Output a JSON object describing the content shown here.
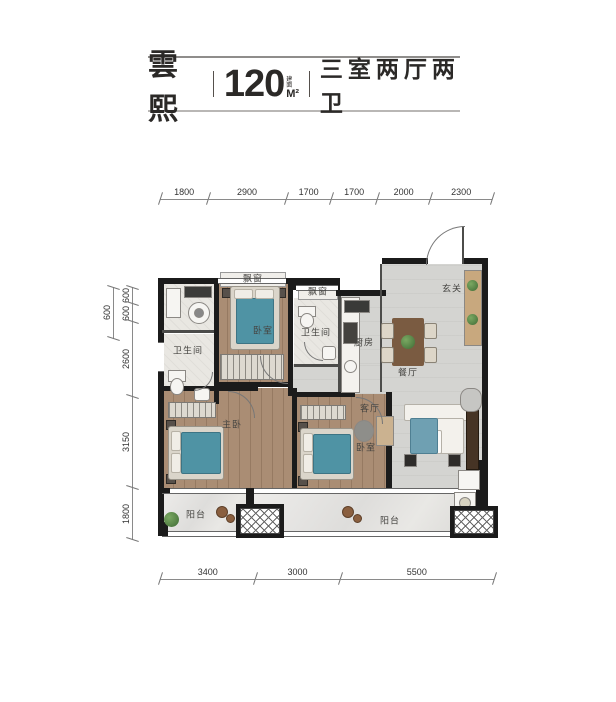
{
  "title": {
    "name": "雲熙",
    "area_value": "120",
    "area_prefix": "建面",
    "area_unit": "M²",
    "layout_desc": "三室两厅两卫"
  },
  "dimensions": {
    "top": [
      "1800",
      "2900",
      "1700",
      "1700",
      "2000",
      "2300"
    ],
    "left_outer": "600",
    "left": [
      "600",
      "600",
      "2600",
      "3150",
      "1800"
    ],
    "bottom": [
      "3400",
      "3000",
      "5500"
    ]
  },
  "rooms": {
    "bay_window_1": "飘窗",
    "bay_window_2": "飘窗",
    "bedroom_top": "卧室",
    "bathroom_left": "卫生间",
    "bathroom_mid": "卫生间",
    "kitchen": "厨房",
    "foyer": "玄关",
    "dining": "餐厅",
    "living": "客厅",
    "master_bedroom": "主卧",
    "bedroom_bottom": "卧室",
    "balcony_left": "阳台",
    "balcony_right": "阳台"
  },
  "colors": {
    "wall": "#1b1b1b",
    "wood_floor": "#aa8d74",
    "gray_floor": "#d4d4d1",
    "bed": "#4f93a4",
    "marble": "#e7e6e3",
    "plant": "#4f7f3f",
    "dim_text": "#333333"
  }
}
